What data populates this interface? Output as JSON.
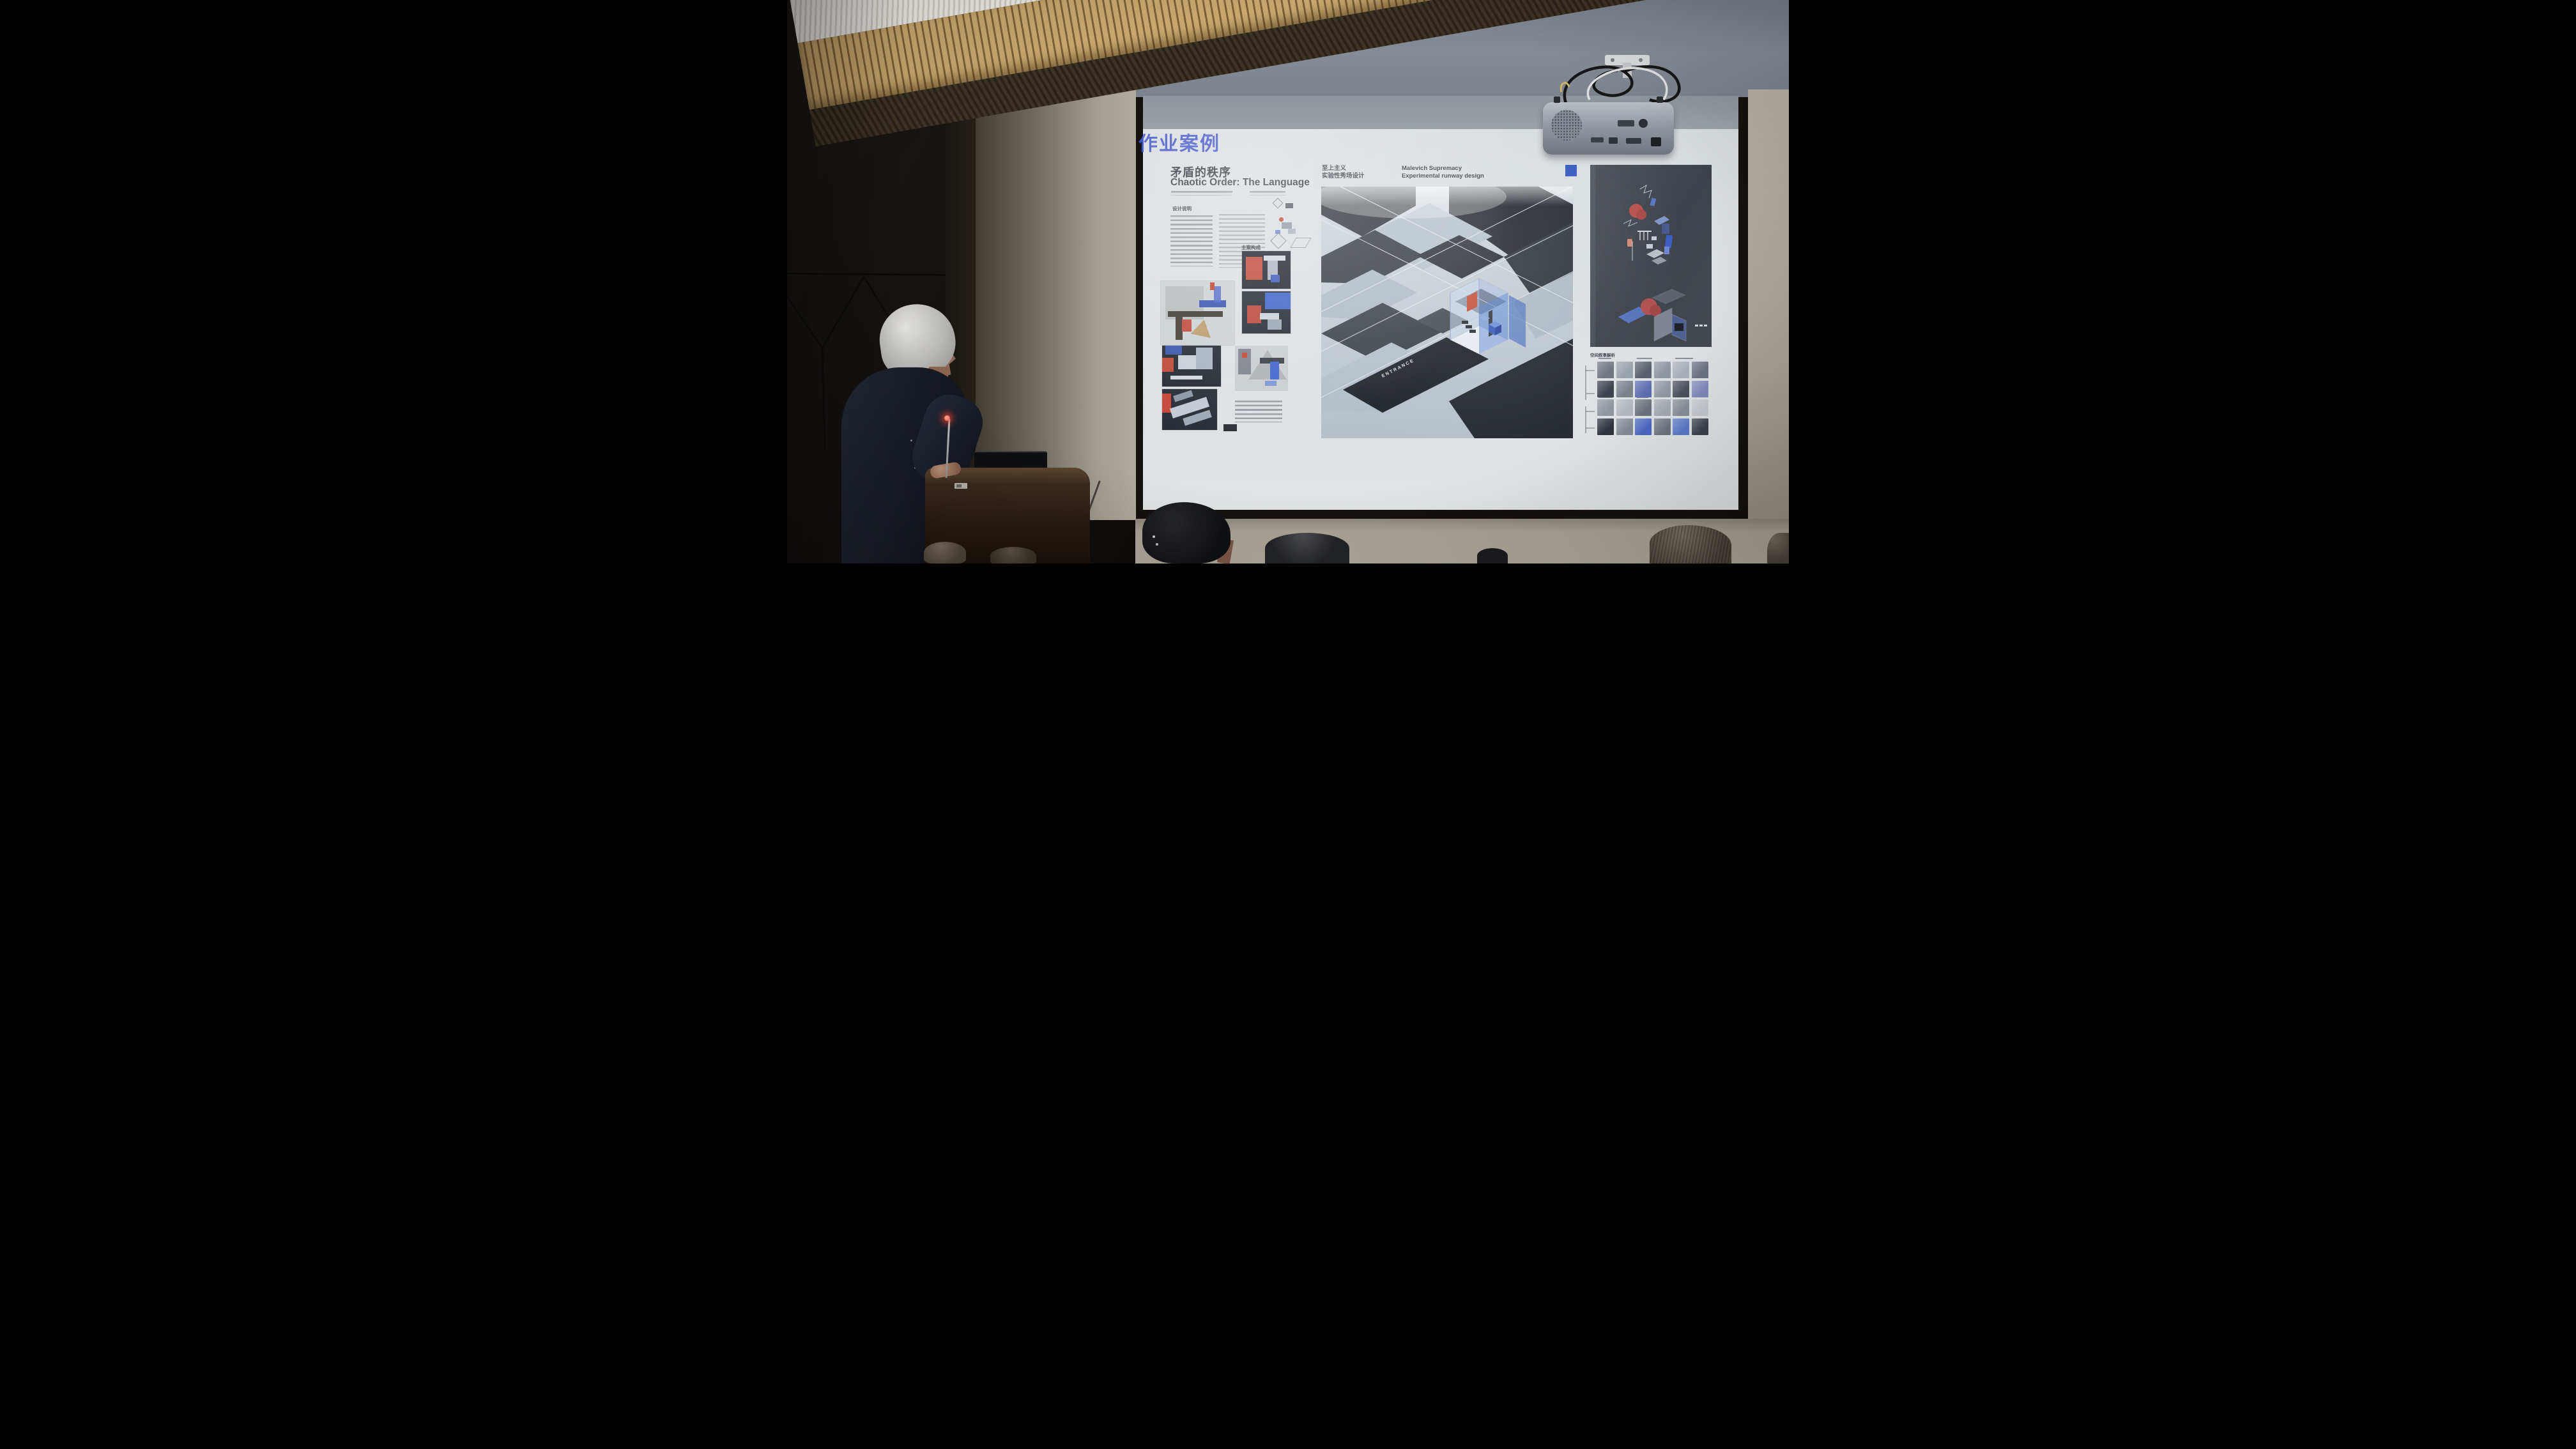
{
  "slide": {
    "section_title": "作业案例",
    "project": {
      "title_zh": "矛盾的秩序",
      "title_en": "Chaotic Order: The Language"
    },
    "columns": {
      "design_notes_label": "设计说明",
      "composition_label": "主案构成"
    },
    "runway": {
      "subtitle_zh_line1": "至上主义",
      "subtitle_zh_line2": "实验性秀场设计",
      "subtitle_en_line1": "Malevich Supremacy",
      "subtitle_en_line2": "Experimental runway design"
    },
    "right_column": {
      "analysis_label": "空间叙事解析"
    },
    "main_render": {
      "entrance_label": "ENTRANCE"
    }
  },
  "colors": {
    "accent_blue": "#3f53c4",
    "suprematist_red": "#c0452f",
    "suprematist_blue": "#3557c0",
    "screen_white": "#dadfe2",
    "wall_beige": "#b0ab9f",
    "wall_dark": "#171512",
    "ceiling_wood": "#c9a76b",
    "thumb_palette": [
      "#707680",
      "#9aa2ab",
      "#5a616c",
      "#8e96a0",
      "#a9b0b8",
      "#6a7180",
      "#3d434e",
      "#7b828c",
      "#5d6db0",
      "#9198a2",
      "#4c525c",
      "#7e88b8",
      "#8f969e",
      "#b0b6bc",
      "#6d737c",
      "#a2a8af",
      "#878e96",
      "#c2c7cc",
      "#2e333c",
      "#848b94",
      "#4a66c0",
      "#6e747e",
      "#5a79c8",
      "#3a404a"
    ]
  }
}
